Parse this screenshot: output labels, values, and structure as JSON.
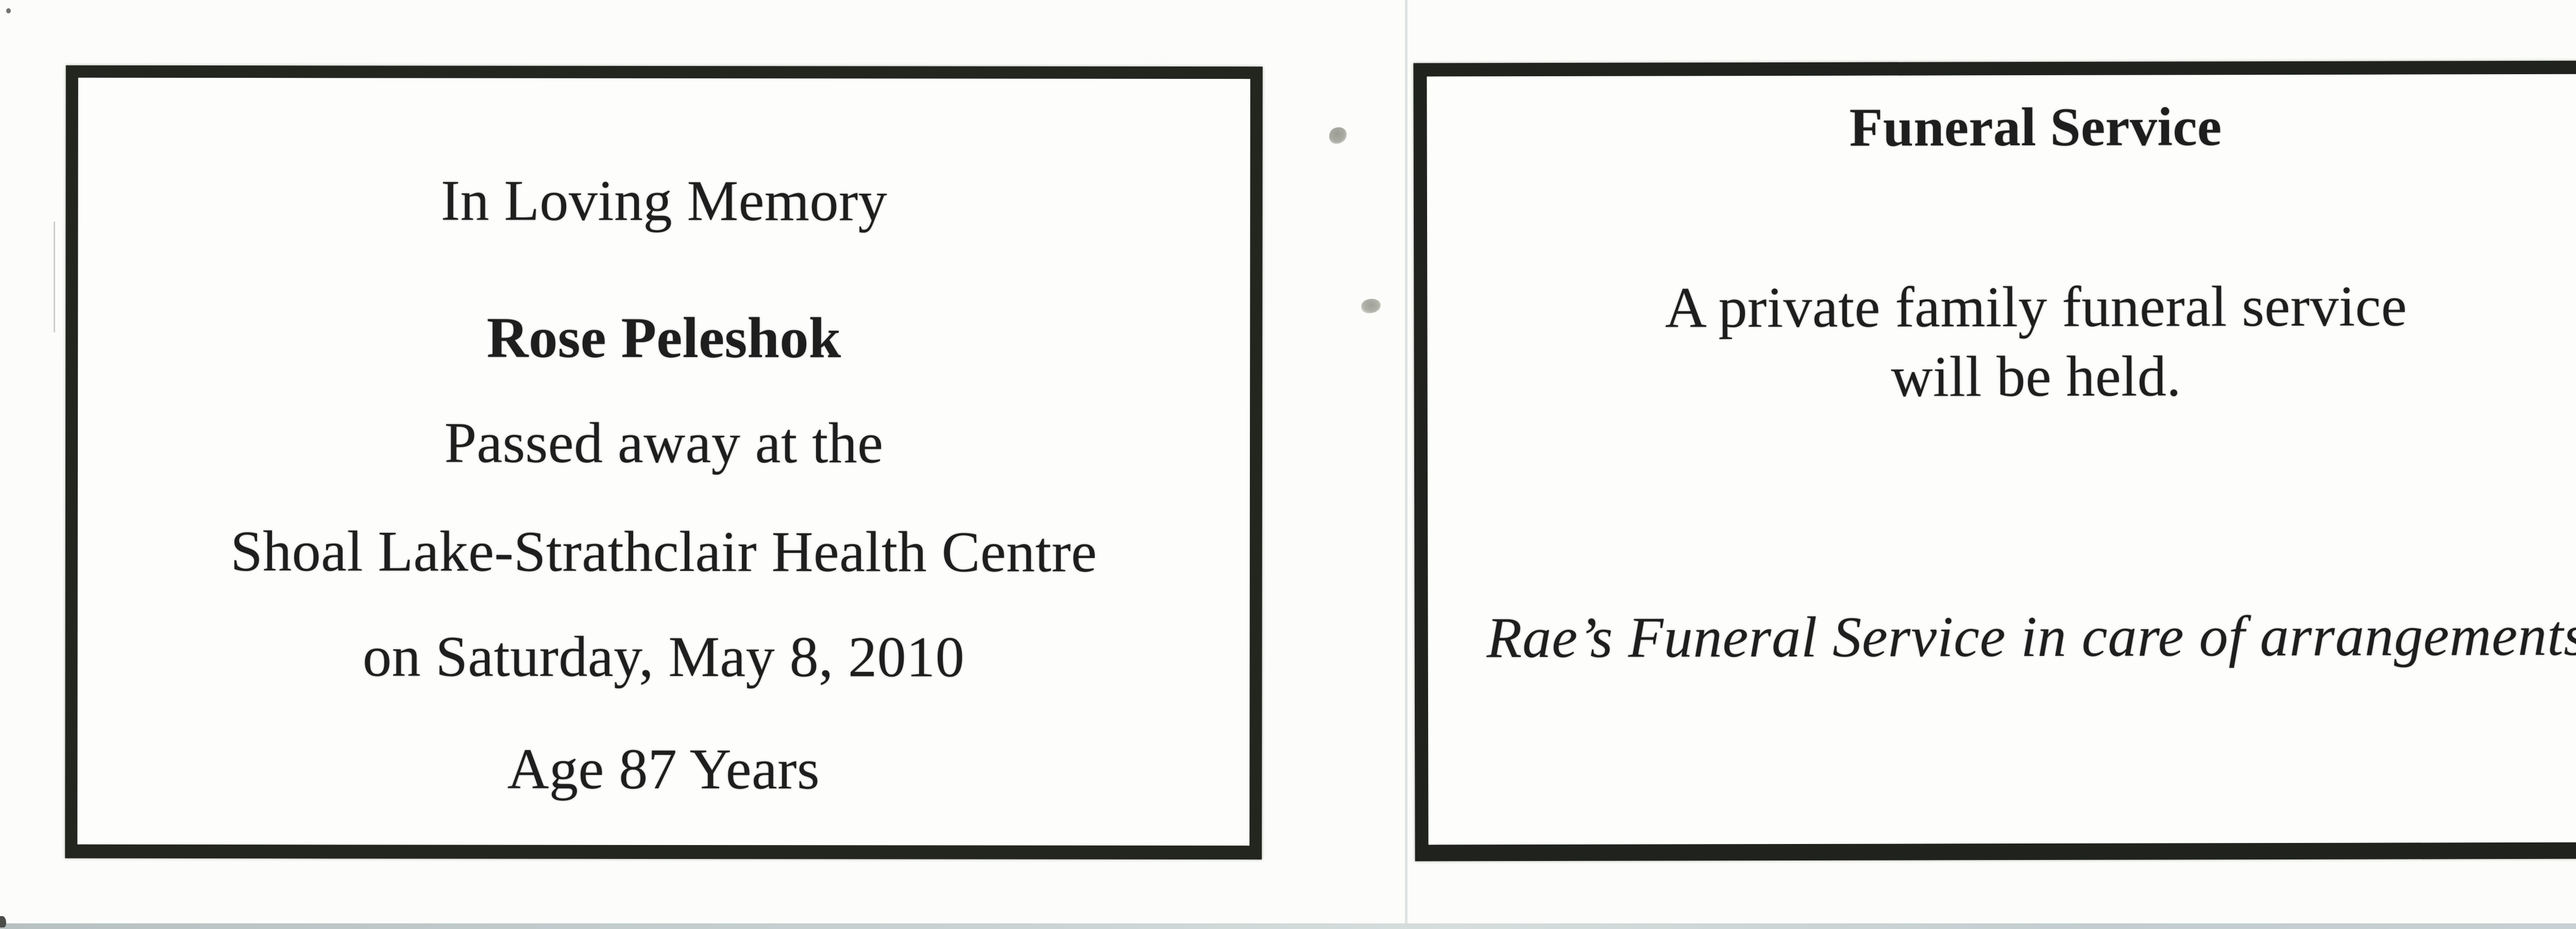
{
  "scan": {
    "background_color": "#fcfcfa",
    "ink_color": "#1e1e1e",
    "border_color": "#23261f",
    "scanner_strip_color": "#c9d2d3"
  },
  "memorial_card": {
    "heading": "In Loving Memory",
    "deceased_name": "Rose Peleshok",
    "passed_line": "Passed away at the",
    "location_line": "Shoal Lake-Strathclair Health Centre",
    "date_line": "on Saturday, May 8, 2010",
    "age_line": "Age 87 Years"
  },
  "service_card": {
    "title": "Funeral Service",
    "body_line1": "A private family funeral service",
    "body_line2": "will be held.",
    "arrangements_note": "Rae’s Funeral Service in care of arrangements"
  }
}
